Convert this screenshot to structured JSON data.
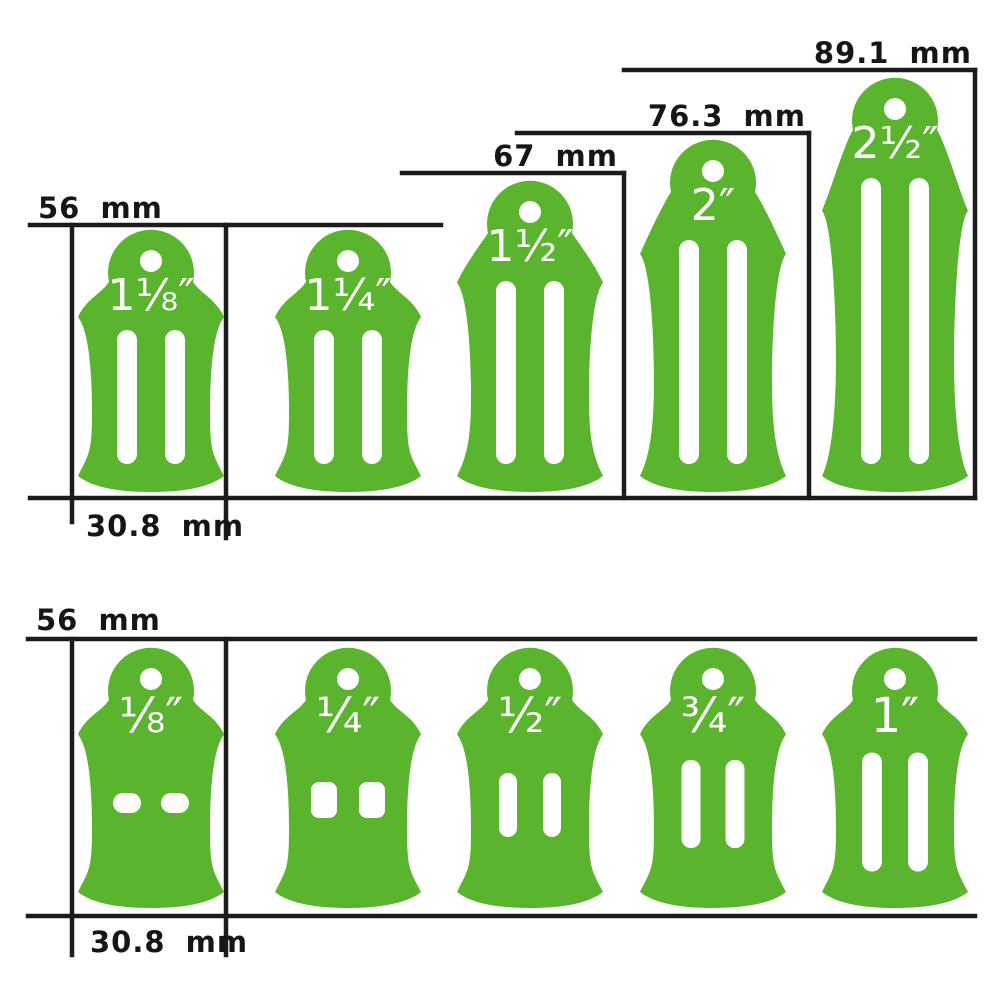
{
  "diagram": {
    "background": "#ffffff",
    "shape_color": "#5bb42e",
    "line_color": "#1c1c1c",
    "text_color": "#161616",
    "shape_label_color": "#ffffff"
  },
  "top_row": {
    "dim_height_labels": [
      "56 mm",
      "67 mm",
      "76.3 mm",
      "89.1 mm"
    ],
    "width_label": "30.8 mm",
    "items": [
      {
        "label": "1⅛″",
        "height_mm": "56"
      },
      {
        "label": "1¼″",
        "height_mm": "56"
      },
      {
        "label": "1½″",
        "height_mm": "67"
      },
      {
        "label": "2″",
        "height_mm": "76.3"
      },
      {
        "label": "2½″",
        "height_mm": "89.1"
      }
    ]
  },
  "bottom_row": {
    "dim_height_label": "56 mm",
    "width_label": "30.8 mm",
    "items": [
      {
        "label": "⅛″",
        "height_mm": "56"
      },
      {
        "label": "¼″",
        "height_mm": "56"
      },
      {
        "label": "½″",
        "height_mm": "56"
      },
      {
        "label": "¾″",
        "height_mm": "56"
      },
      {
        "label": "1″",
        "height_mm": "56"
      }
    ]
  }
}
